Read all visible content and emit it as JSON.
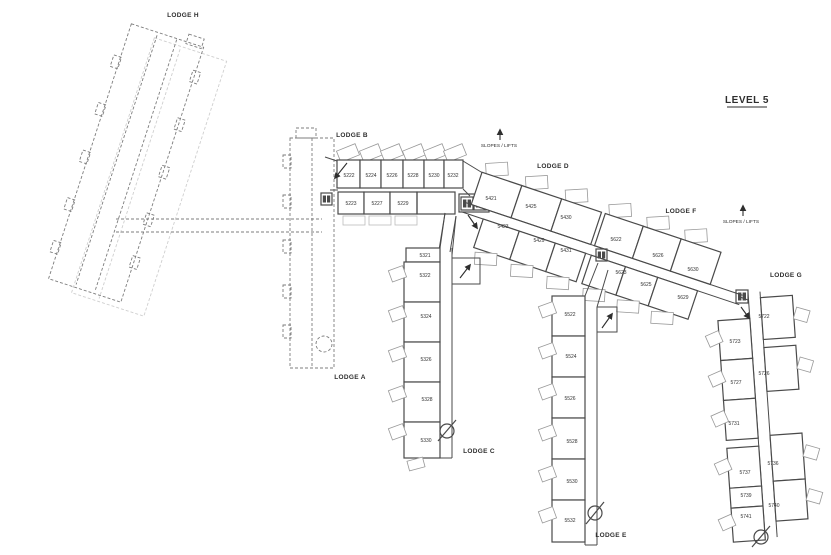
{
  "title": "LEVEL 5",
  "legend": {
    "slopes_lifts": "SLOPES / LIFTS"
  },
  "lodges": {
    "a": "LODGE A",
    "b": "LODGE B",
    "c": "LODGE C",
    "d": "LODGE D",
    "e": "LODGE E",
    "f": "LODGE F",
    "g": "LODGE G",
    "h": "LODGE H"
  },
  "rooms": {
    "b_top": [
      "5222",
      "5224",
      "5226",
      "5228",
      "5230",
      "5232"
    ],
    "b_bottom": [
      "5223",
      "5227",
      "5229"
    ],
    "c": [
      "5321",
      "5322",
      "5324",
      "5326",
      "5328",
      "5330"
    ],
    "d_top": [
      "5421",
      "5425",
      "5430"
    ],
    "d_bottom": [
      "5423",
      "5429",
      "5431"
    ],
    "e": [
      "5522",
      "5524",
      "5526",
      "5528",
      "5530",
      "5532"
    ],
    "f_top": [
      "5622",
      "5626",
      "5630"
    ],
    "f_bottom": [
      "5623",
      "5625",
      "5629"
    ],
    "g_left": [
      "5723",
      "5727",
      "5731",
      "5737",
      "5739",
      "5741"
    ],
    "g_right": [
      "5722",
      "5726",
      "5736",
      "5740"
    ]
  },
  "icons": [
    "lift-icon",
    "door-slash-icon",
    "stair-arrow-icon",
    "up-arrow-icon"
  ],
  "colors": {
    "wall": "#4a4a4a",
    "balcony": "#999999",
    "ghost": "#7d7d7d",
    "ghost_light": "#cfcfcf",
    "text": "#2e2e2e",
    "bg": "#ffffff"
  }
}
